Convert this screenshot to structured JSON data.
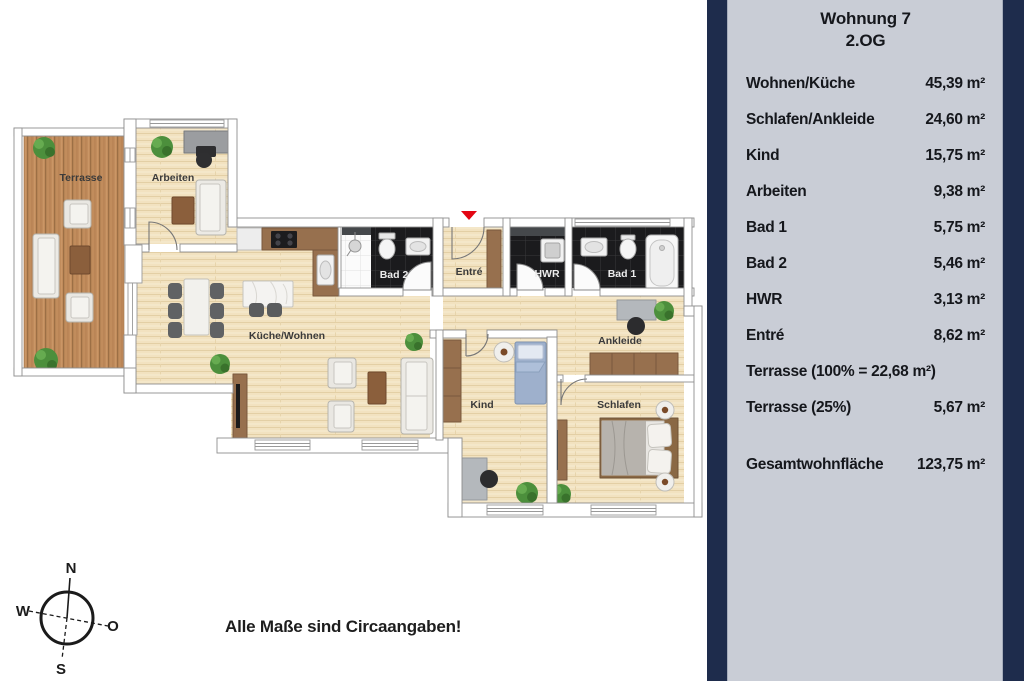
{
  "panel": {
    "title_line1": "Wohnung 7",
    "title_line2": "2.OG",
    "rows": [
      {
        "label": "Wohnen/Küche",
        "value": "45,39 m²"
      },
      {
        "label": "Schlafen/Ankleide",
        "value": "24,60 m²"
      },
      {
        "label": "Kind",
        "value": "15,75 m²"
      },
      {
        "label": "Arbeiten",
        "value": "9,38 m²"
      },
      {
        "label": "Bad 1",
        "value": "5,75 m²"
      },
      {
        "label": "Bad 2",
        "value": "5,46 m²"
      },
      {
        "label": "HWR",
        "value": "3,13 m²"
      },
      {
        "label": "Entré",
        "value": "8,62 m²"
      },
      {
        "label": "Terrasse (100% = 22,68 m²)",
        "value": ""
      },
      {
        "label": "Terrasse (25%)",
        "value": "5,67 m²"
      }
    ],
    "total": {
      "label": "Gesamtwohnfläche",
      "value": "123,75 m²"
    }
  },
  "plan": {
    "rooms": {
      "terrasse": "Terrasse",
      "arbeiten": "Arbeiten",
      "kueche_wohnen": "Küche/Wohnen",
      "bad2": "Bad 2",
      "entre": "Entré",
      "hwr": "HWR",
      "bad1": "Bad 1",
      "ankleide": "Ankleide",
      "kind": "Kind",
      "schlafen": "Schlafen"
    }
  },
  "compass": {
    "n": "N",
    "o": "O",
    "s": "S",
    "w": "W"
  },
  "note": "Alle Maße sind Circaangaben!",
  "colors": {
    "panel_navy": "#1e2c4c",
    "panel_gray": "#c9cdd6",
    "entrance_marker_red": "#e30613",
    "floor_wood": "#f2e2c0",
    "terrace_wood": "#c18c5c",
    "bath_tile": "#1b1b1d"
  }
}
